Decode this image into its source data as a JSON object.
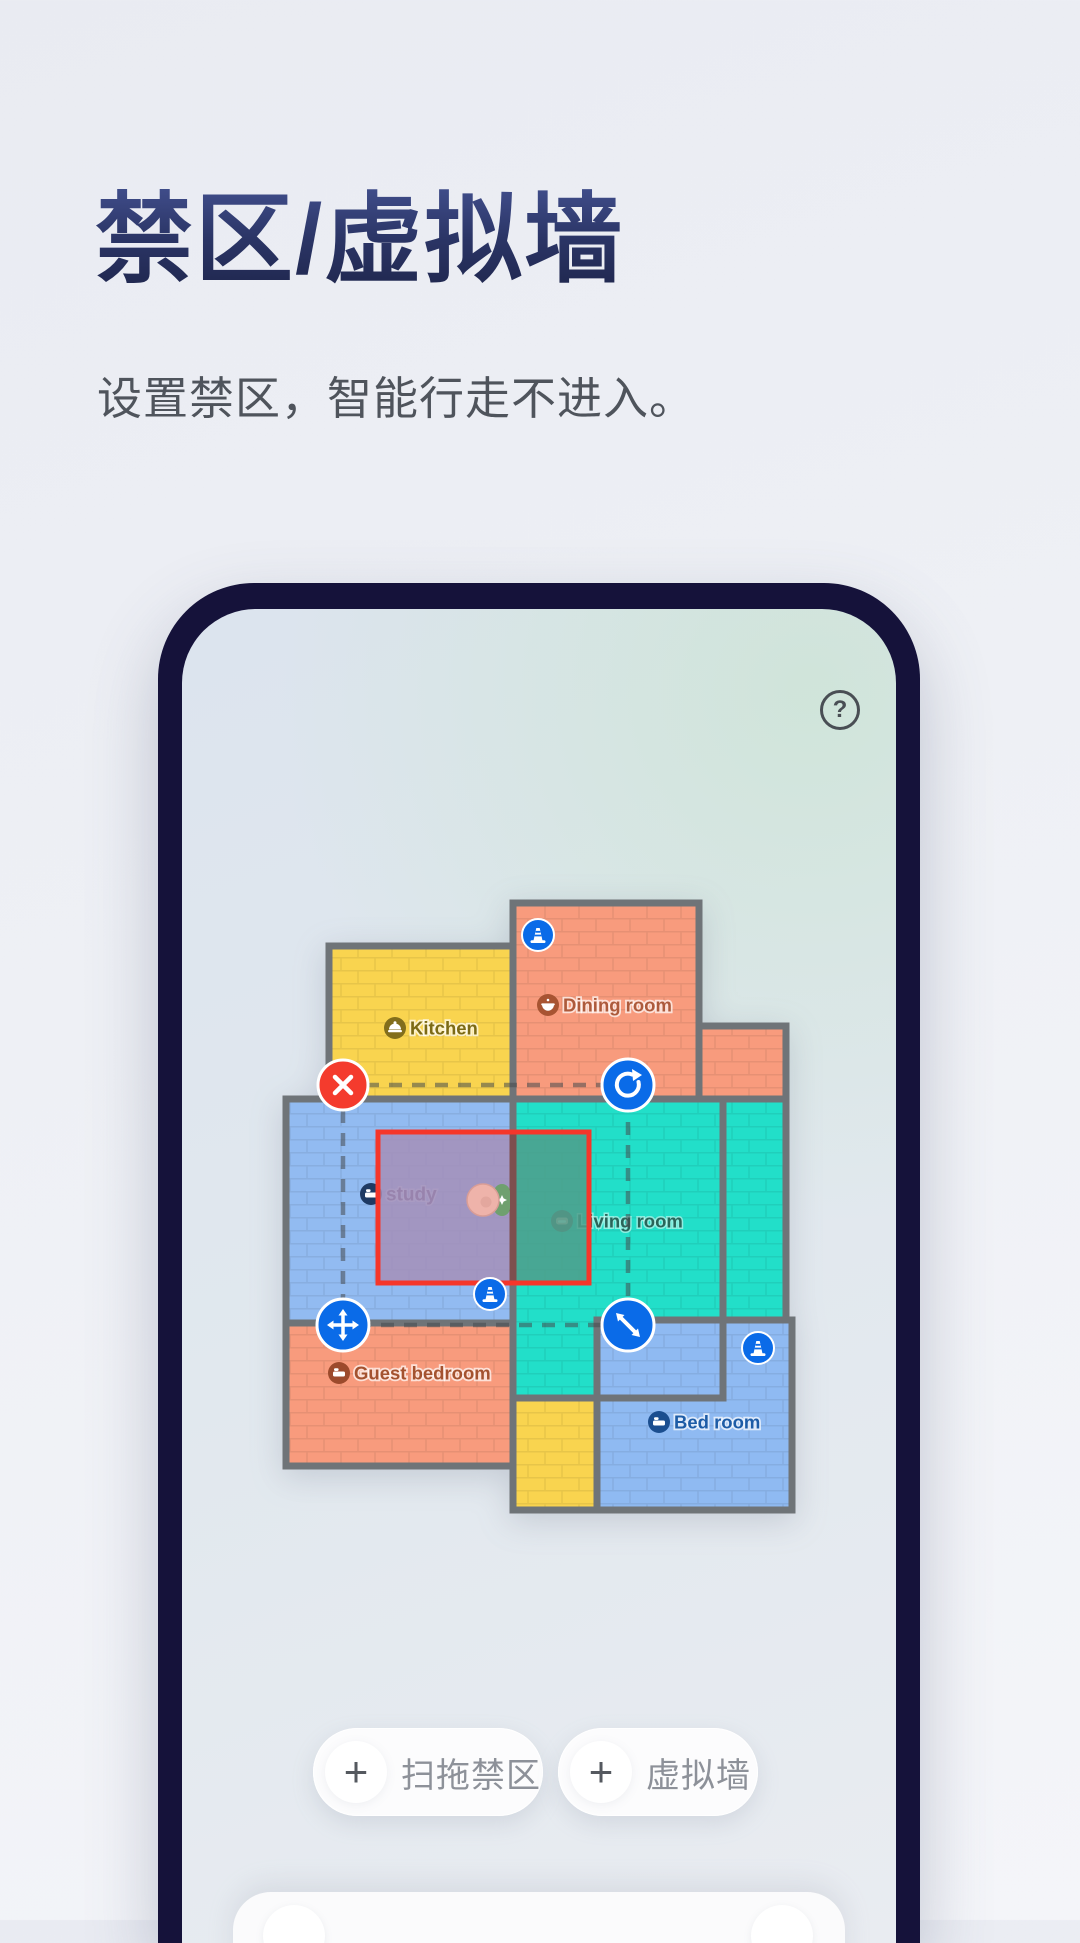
{
  "page": {
    "title": "禁区/虚拟墙",
    "subtitle": "设置禁区，智能行走不进入。"
  },
  "phone": {
    "help_glyph": "?",
    "map": {
      "wall_color": "#6F7478",
      "marker_color": "#0A6BE8",
      "rooms": [
        {
          "label": "Kitchen",
          "color": "#F9D44F",
          "label_color": "#7C6A15",
          "icon_bg": "#826E1C",
          "icon": "cloche-icon"
        },
        {
          "label": "Dining room",
          "color": "#F89B7D",
          "label_color": "#AD5A3B",
          "icon_bg": "#A85432",
          "icon": "bowl-icon"
        },
        {
          "label": "study",
          "color": "#92BBF1",
          "label_color": "#533F6B",
          "icon_bg": "#1E3A63",
          "icon": "bed-icon"
        },
        {
          "label": "Living room",
          "color": "#22DFC9",
          "label_color": "#2A6459",
          "icon_bg": "#5E6565",
          "icon": "sofa-icon"
        },
        {
          "label": "Guest bedroom",
          "color": "#F89B7D",
          "label_color": "#A4522F",
          "icon_bg": "#9C4A2C",
          "icon": "bed-icon"
        },
        {
          "label": "Bed room",
          "color": "#8FBAF2",
          "label_color": "#1D5CA6",
          "icon_bg": "#1B4E8F",
          "icon": "bed-icon"
        }
      ],
      "corridor_color": "#F9D44F",
      "zone": {
        "border_color": "#F5362A",
        "overlay_study": "#A48FB9",
        "overlay_living": "#4F9D8B",
        "delete_color": "#F43B2D",
        "control_color": "#0A6BE8"
      },
      "robot": {
        "body_color": "#EEB3AA",
        "dock_color": "#6FA06F"
      }
    },
    "actions": [
      {
        "plus": "+",
        "label": "扫拖禁区"
      },
      {
        "plus": "+",
        "label": "虚拟墙"
      }
    ]
  }
}
